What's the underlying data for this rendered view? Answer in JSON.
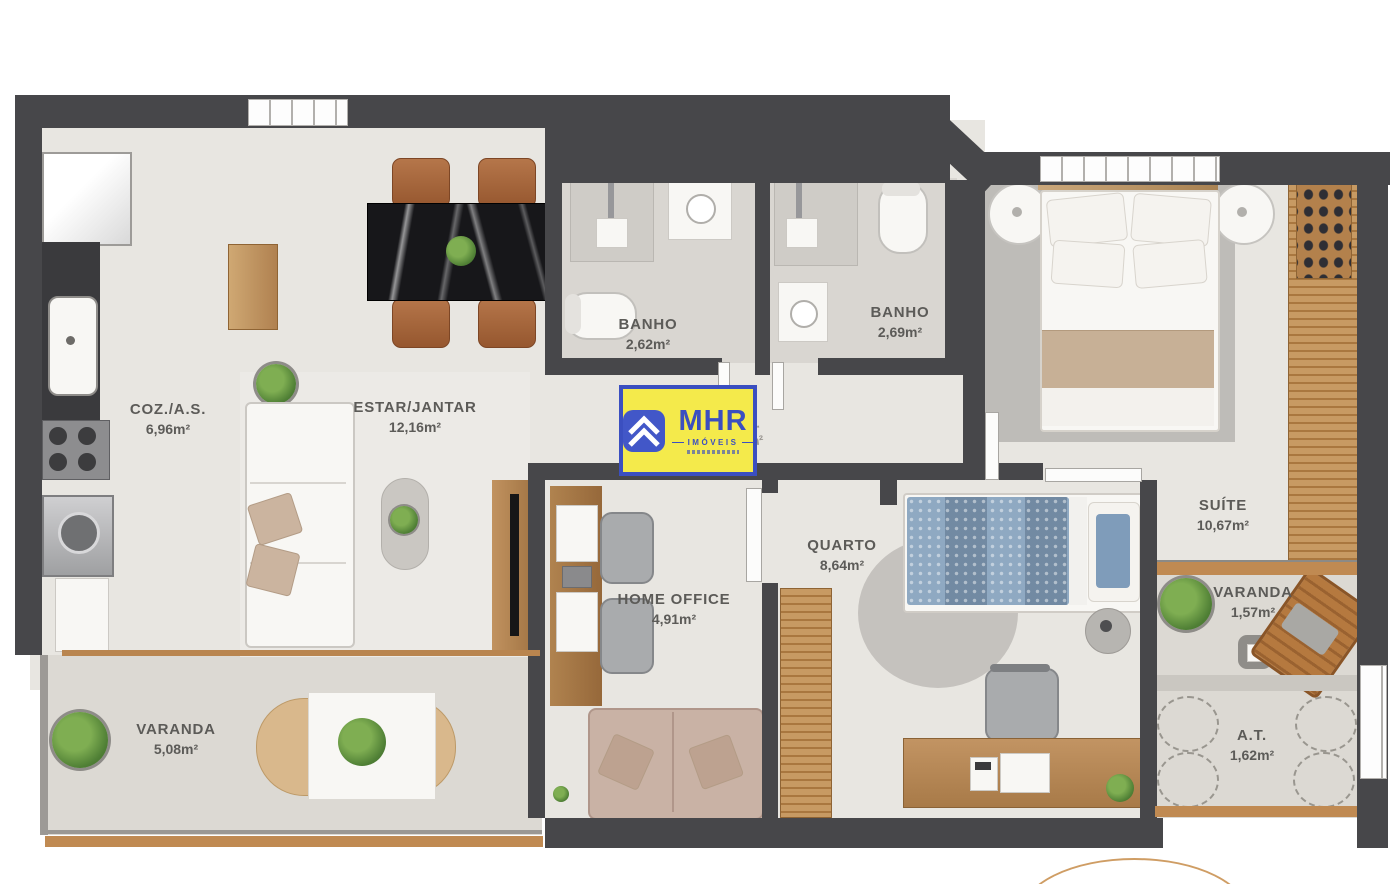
{
  "rooms": [
    {
      "id": "coz",
      "name": "COZ./A.S.",
      "area": "6,96m²"
    },
    {
      "id": "estar",
      "name": "ESTAR/JANTAR",
      "area": "12,16m²"
    },
    {
      "id": "banho1",
      "name": "BANHO",
      "area": "2,62m²"
    },
    {
      "id": "banho2",
      "name": "BANHO",
      "area": "2,69m²"
    },
    {
      "id": "suite",
      "name": "SUÍTE",
      "area": "10,67m²"
    },
    {
      "id": "quarto",
      "name": "QUARTO",
      "area": "8,64m²"
    },
    {
      "id": "homeoffice",
      "name": "HOME OFFICE",
      "area": "4,91m²"
    },
    {
      "id": "varanda1",
      "name": "VARANDA",
      "area": "5,08m²"
    },
    {
      "id": "varanda2",
      "name": "VARANDA",
      "area": "1,57m²"
    },
    {
      "id": "at",
      "name": "A.T.",
      "area": "1,62m²"
    },
    {
      "id": "circ",
      "name": "CIRC.",
      "area": "1,47m²"
    }
  ],
  "logo": {
    "brand": "MHR",
    "subtitle": "IMÓVEIS"
  },
  "colors": {
    "wall": "#47474a",
    "floor": "#e8e6e1",
    "balcony_floor": "#dcd9d3",
    "wood": "#b98c58",
    "logo_yellow": "#f4ea4b",
    "logo_blue": "#3b4fc0",
    "rail_accent": "#c08a52",
    "bed_blue": "#8fa9c2",
    "sofa_beige": "#c9b2a5",
    "chair_brown": "#a4683e"
  }
}
